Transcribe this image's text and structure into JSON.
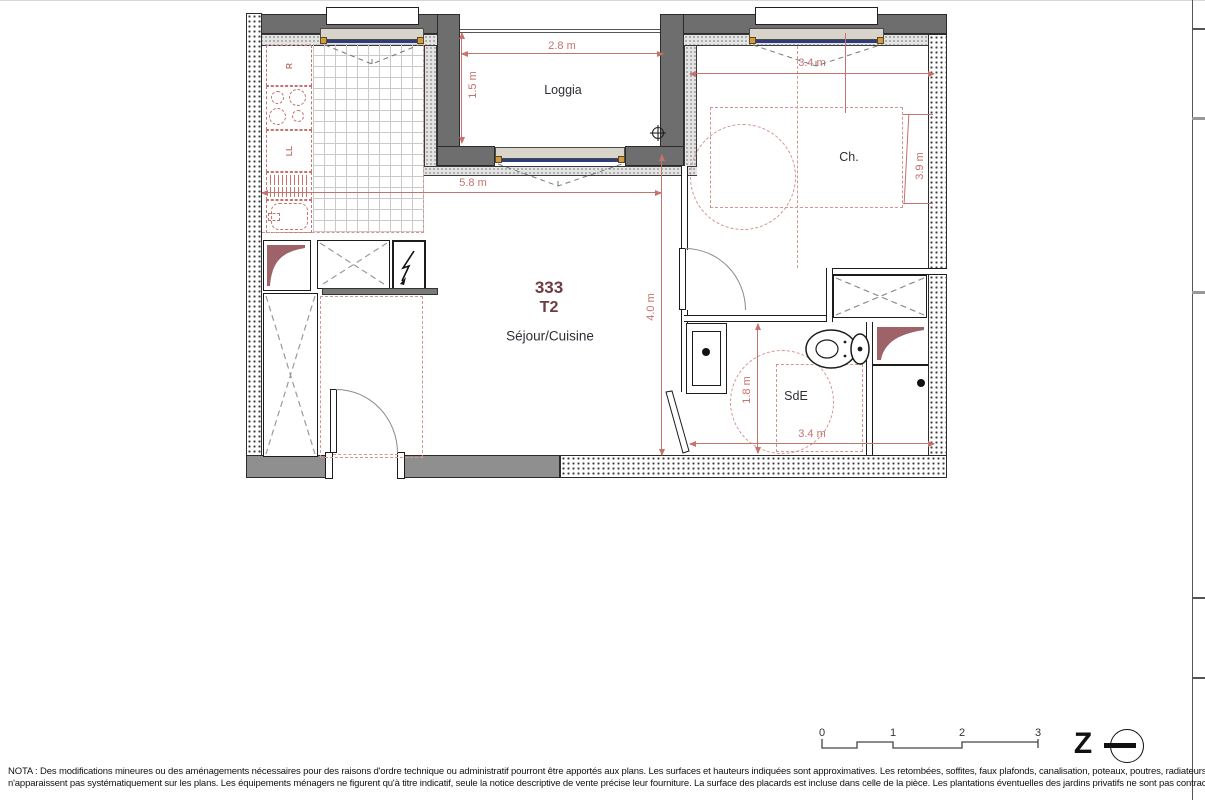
{
  "plan": {
    "unit_number": "333",
    "unit_type": "T2",
    "rooms": {
      "loggia": "Loggia",
      "bedroom": "Ch.",
      "living": "Séjour/Cuisine",
      "shower_room": "SdE"
    },
    "kitchen": {
      "fridge_label": "R",
      "washer_label": "LL"
    },
    "dims": {
      "loggia_width": "2.8 m",
      "loggia_depth": "1.5 m",
      "living_width": "5.8 m",
      "living_depth": "4.0 m",
      "bedroom_width": "3.4 m",
      "bedroom_depth": "3.9 m",
      "shower_room_depth": "1.8 m",
      "shower_room_width": "3.4 m"
    }
  },
  "scale_bar": {
    "labels": [
      "0",
      "1",
      "2",
      "3"
    ]
  },
  "north_arrow": {
    "letter": "Z"
  },
  "nota": {
    "line1": "NOTA : Des modifications mineures ou des aménagements nécessaires pour des raisons d'ordre technique ou administratif pourront être apportés aux plans. Les surfaces et hauteurs indiquées sont approximatives. Les retombées, soffites, faux plafonds, canalisation, poteaux, poutres, radiateurs",
    "line2": "n'apparaissent pas systématiquement sur les plans.  Les équipements ménagers ne figurent qu'à titre indicatif, seule la notice descriptive de vente précise leur fourniture. La surface des placards est incluse dans celle de la pièce. Les plantations éventuelles des jardins privatifs ne sont pas contractuelles."
  },
  "colors": {
    "wall_dark": "#6e6e6e",
    "dimension": "#c4736d",
    "unit_accent": "#6e3b42",
    "glazing": "#2e3d7a",
    "frame_orange": "#d79b3f",
    "duct_fill": "#9d6368"
  }
}
